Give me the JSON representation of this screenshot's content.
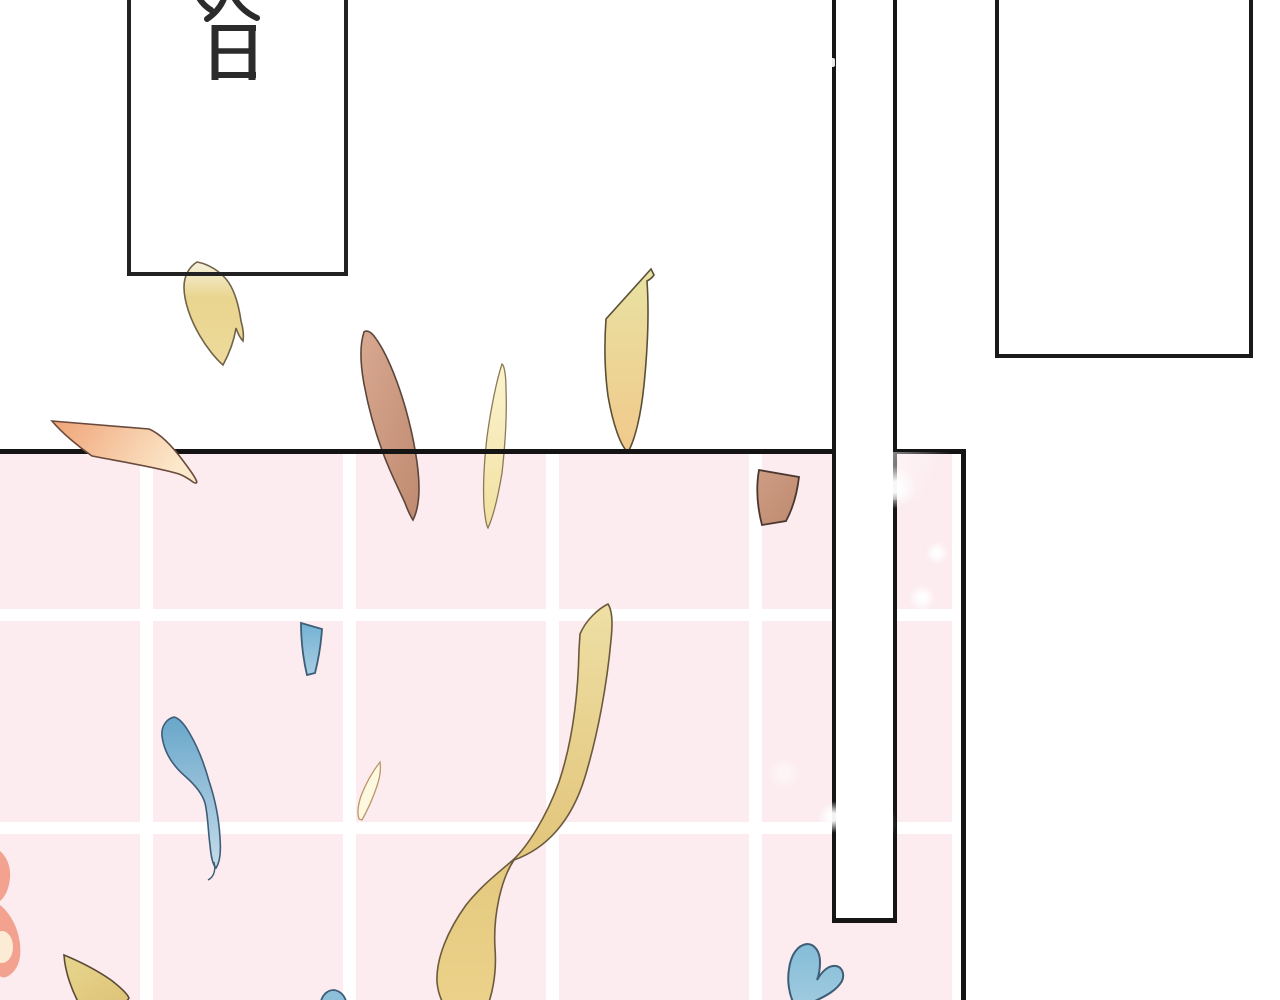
{
  "scene": {
    "type": "comic-panel",
    "description": "webtoon transition panel with falling confetti over a pink tiled wall",
    "background_color": "#ffffff",
    "ink_color": "#1a1a1a",
    "caption_box": {
      "text": "次日",
      "translation": "Next day",
      "orientation": "vertical"
    },
    "tiled_wall": {
      "tile_color": "#fcebef",
      "grout_color": "#ffffff",
      "edge_color": "#141414"
    },
    "pole": {
      "fill": "#ffffff",
      "outline": "#161616"
    },
    "empty_panel": {
      "fill": "#ffffff",
      "outline": "#1a1a1a"
    },
    "confetti": [
      {
        "id": "petal-yellow-top-left",
        "color": "#e7d189",
        "outline": "#6f6247"
      },
      {
        "id": "petal-orange-parallelogram",
        "color": "#efa377",
        "outline": "#6a4a3c"
      },
      {
        "id": "petal-tan-curved",
        "color": "#cb9a80",
        "outline": "#5a463c"
      },
      {
        "id": "petal-cream-sliver",
        "color": "#f8edbc",
        "outline": "#8a7a58"
      },
      {
        "id": "petal-yellow-kite",
        "color": "#ecd492",
        "outline": "#5a5038"
      },
      {
        "id": "petal-brown-quad",
        "color": "#c28f75",
        "outline": "#4a3830"
      },
      {
        "id": "petal-blue-trapezoid",
        "color": "#74b2d4",
        "outline": "#3e5d77"
      },
      {
        "id": "petal-blue-wing",
        "color": "#8fc0da",
        "outline": "#3e5d77"
      },
      {
        "id": "petal-cream-small",
        "color": "#fdf8e0",
        "outline": "#bd9668"
      },
      {
        "id": "ribbon-yellow-twisted",
        "color": "#ecd794",
        "outline": "#6b5a3c"
      },
      {
        "id": "heart-salmon-partial",
        "color": "#f2a28e",
        "outline": "none"
      },
      {
        "id": "petal-yellow-bottom-left",
        "color": "#e4d28c",
        "outline": "#5a4a38"
      },
      {
        "id": "heart-blue-bottom-right",
        "color": "#8cc0da",
        "outline": "#3e5d77"
      },
      {
        "id": "petal-blue-bottom-center",
        "color": "#8cc0da",
        "outline": "#3e5d77"
      }
    ],
    "sparkles": {
      "color": "#ffffff",
      "count": 8
    }
  }
}
